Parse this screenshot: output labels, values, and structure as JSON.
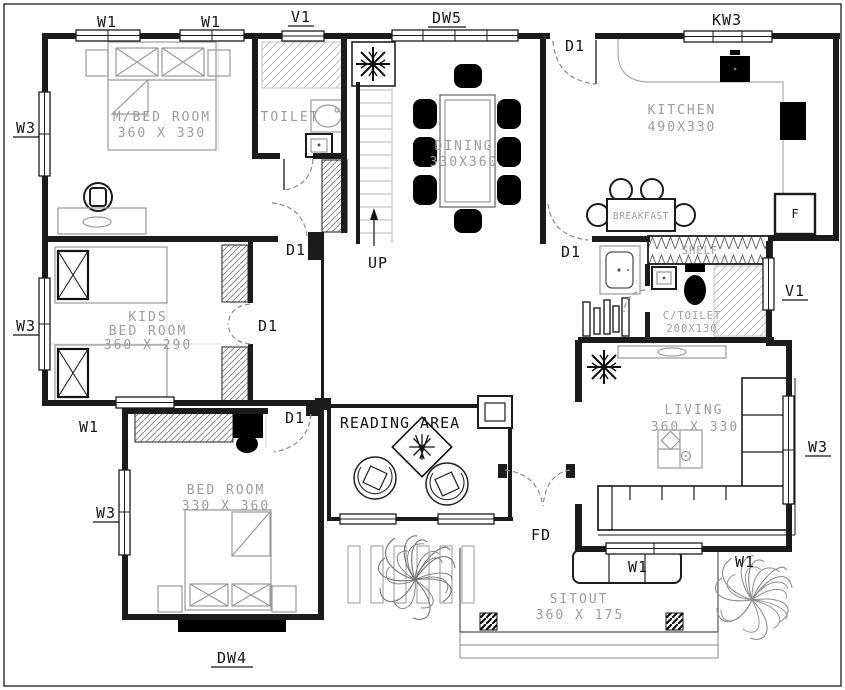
{
  "drawing": {
    "rooms": {
      "master_bedroom": {
        "name": "M/BED ROOM",
        "size": "360 X 330"
      },
      "toilet": {
        "name": "TOILET"
      },
      "dining": {
        "name": "DINING",
        "size": "330X360"
      },
      "kitchen": {
        "name": "KITCHEN",
        "size": "490X330"
      },
      "breakfast": {
        "name": "BREAKFAST"
      },
      "shelf": {
        "name": "SHELF"
      },
      "kids_bedroom": {
        "line1": "KIDS",
        "line2": "BED ROOM",
        "size": "360 X 290"
      },
      "c_toilet": {
        "name": "C/TOILET",
        "size": "200X130"
      },
      "living": {
        "name": "LIVING",
        "size": "360 X 330"
      },
      "reading_area": {
        "name": "READING AREA"
      },
      "bedroom": {
        "name": "BED ROOM",
        "size": "330 X 360"
      },
      "sitout": {
        "name": "SITOUT",
        "size": "360 X 175"
      }
    },
    "markers": {
      "window_w1": "W1",
      "window_w3": "W3",
      "ventilator_v1": "V1",
      "door_d1": "D1",
      "door_window_dw5": "DW5",
      "door_window_dw4": "DW4",
      "kitchen_window_kw3": "KW3",
      "stairs_up": "UP",
      "front_door_fd": "FD",
      "fridge_f": "F"
    },
    "colors": {
      "wall": "#1b1b1b",
      "furniture_gray": "#9a9a9a",
      "room_label": "#9c9c9c",
      "marker_label": "#151515"
    }
  }
}
